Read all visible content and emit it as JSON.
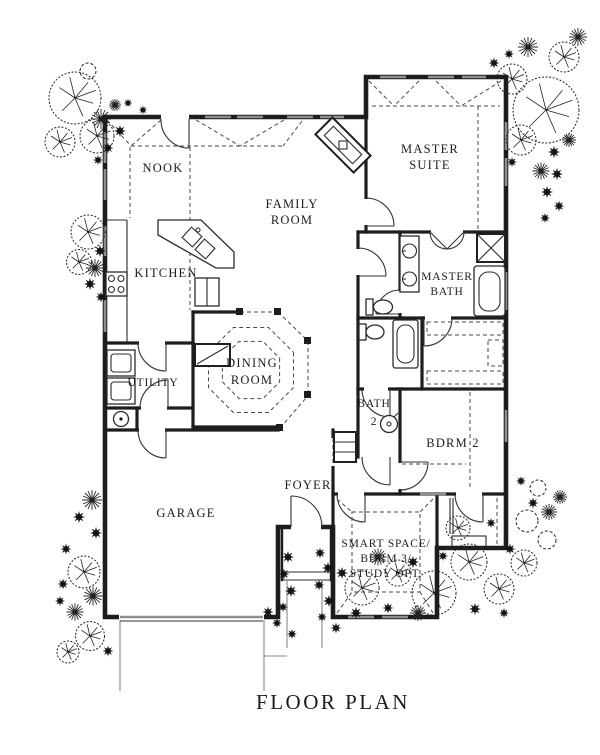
{
  "title": "FLOOR PLAN",
  "colors": {
    "paper": "#ffffff",
    "ink": "#1d1d1d",
    "window": "#8f8f8f",
    "dash": "#4a4a4a",
    "site": "#8a8a8a"
  },
  "rooms": {
    "nook": {
      "label": "NOOK"
    },
    "family_room": {
      "line1": "FAMILY",
      "line2": "ROOM"
    },
    "master_suite": {
      "line1": "MASTER",
      "line2": "SUITE"
    },
    "kitchen": {
      "label": "KITCHEN"
    },
    "master_bath": {
      "line1": "MASTER",
      "line2": "BATH"
    },
    "utility": {
      "label": "UTILITY"
    },
    "dining_room": {
      "line1": "DINING",
      "line2": "ROOM"
    },
    "bath_2": {
      "line1": "BATH",
      "line2": "2"
    },
    "bedroom_2": {
      "label": "BDRM 2"
    },
    "foyer": {
      "label": "FOYER"
    },
    "garage": {
      "label": "GARAGE"
    },
    "smart_space": {
      "line1": "SMART SPACE/",
      "line2": "BDRM 3/",
      "line3": "STUDY OPT."
    }
  }
}
